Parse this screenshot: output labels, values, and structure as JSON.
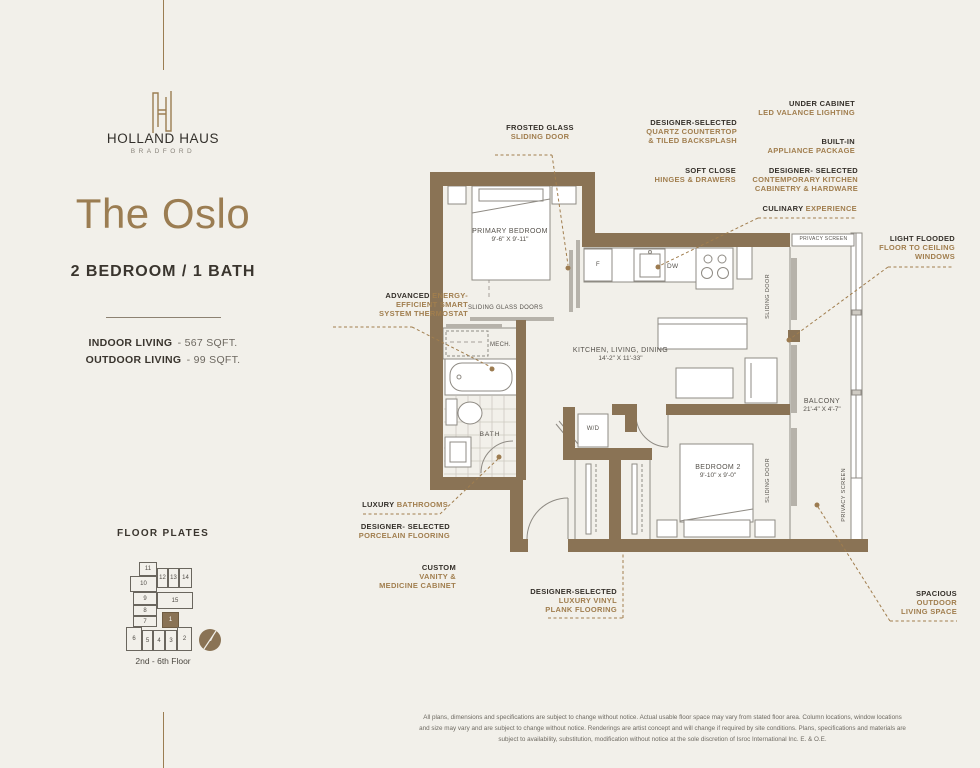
{
  "brand": {
    "name": "HOLLAND HAUS",
    "location": "BRADFORD"
  },
  "unit": {
    "title": "The Oslo",
    "layout": "2 BEDROOM / 1 BATH",
    "indoor_label": "INDOOR LIVING",
    "indoor_value": "- 567 SQFT.",
    "outdoor_label": "OUTDOOR LIVING",
    "outdoor_value": "- 99 SQFT."
  },
  "floor_plates": {
    "heading": "FLOOR PLATES",
    "caption": "2nd - 6th Floor",
    "highlighted_unit": "1",
    "units": {
      "u1": "1",
      "u2": "2",
      "u3": "3",
      "u4": "4",
      "u5": "5",
      "u6": "6",
      "u7": "7",
      "u8": "8",
      "u9": "9",
      "u10": "10",
      "u11": "11",
      "u12": "12",
      "u13": "13",
      "u14": "14",
      "u15": "15"
    }
  },
  "rooms": {
    "primary_name": "PRIMARY BEDROOM",
    "primary_dims": "9'-6\" X 9'-11\"",
    "kld_name": "KITCHEN, LIVING, DINING",
    "kld_dims": "14'-2\" X 11'-33\"",
    "bed2_name": "BEDROOM 2",
    "bed2_dims": "9'-10\" x 9'-0\"",
    "balcony_name": "BALCONY",
    "balcony_dims": "21'-4\" X 4'-7\"",
    "bath": "BATH",
    "mech": "MECH.",
    "wd": "W/D",
    "fridge": "F",
    "dishwasher": "DW",
    "sliding_glass_doors": "SLIDING GLASS DOORS",
    "sliding_door": "SLIDING DOOR",
    "privacy_screen": "PRIVACY SCREEN"
  },
  "callouts": {
    "frosted_glass": {
      "dark": "FROSTED GLASS",
      "brown": "SLIDING DOOR"
    },
    "under_cabinet": {
      "dark": "UNDER CABINET",
      "brown": "LED VALANCE LIGHTING"
    },
    "quartz": {
      "dark": "DESIGNER-SELECTED",
      "brown": "QUARTZ COUNTERTOP\n& TILED BACKSPLASH"
    },
    "built_in": {
      "dark": "BUILT-IN",
      "brown": "APPLIANCE PACKAGE"
    },
    "soft_close": {
      "dark": "SOFT CLOSE",
      "brown": "HINGES & DRAWERS"
    },
    "cabinetry": {
      "dark": "DESIGNER- SELECTED",
      "brown": "CONTEMPORARY KITCHEN\nCABINETRY & HARDWARE"
    },
    "culinary": {
      "dark": "CULINARY",
      "brown": "EXPERIENCE"
    },
    "light_flooded": {
      "dark": "LIGHT FLOODED",
      "brown": "FLOOR TO CEILING\nWINDOWS"
    },
    "thermostat": {
      "dark": "ADVANCED",
      "brown": "ENERGY-\nEFFICIENT SMART\nSYSTEM THERMOSTAT"
    },
    "luxury_bath": {
      "dark": "LUXURY",
      "brown": "BATHROOMS"
    },
    "porcelain": {
      "dark": "DESIGNER- SELECTED",
      "brown": "PORCELAIN FLOORING"
    },
    "custom_vanity": {
      "dark": "CUSTOM",
      "brown": "VANITY &\nMEDICINE CABINET"
    },
    "lvp": {
      "dark": "DESIGNER-SELECTED",
      "brown": "LUXURY VINYL\nPLANK FLOORING"
    },
    "outdoor": {
      "dark": "SPACIOUS",
      "brown": "OUTDOOR\nLIVING SPACE"
    }
  },
  "disclaimer": [
    "All plans, dimensions and specifications are subject to change without notice. Actual usable floor space may vary from stated floor area. Column locations, window locations",
    "and size may vary and are subject to change without notice. Renderings are artist concept and will change if required by site conditions. Plans, specifications and materials are",
    "subject to availability, substitution, modification without notice at the sole discretion of Isroc International Inc. E. & O.E."
  ],
  "colors": {
    "accent": "#9b7d52",
    "wall": "#8a7355",
    "callout_dark": "#35302a",
    "callout_brown": "#a17e4e",
    "background": "#f2f0ea"
  }
}
